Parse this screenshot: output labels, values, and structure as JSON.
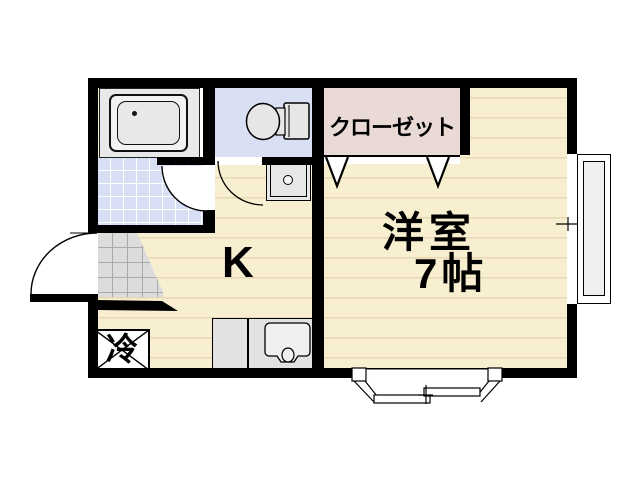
{
  "plan": {
    "rooms": {
      "closet_label": "クローゼット",
      "western_room_label": "洋室",
      "western_room_size": "7帖",
      "kitchen_label": "K",
      "refrigerator_label": "冷"
    },
    "colors": {
      "wall": "#000000",
      "flooring": "#F8EFD0",
      "flooring_line": "#E6D9B4",
      "wet_area_blue": "#D8DEF3",
      "closet_pink": "#E9DAD5",
      "genkan_tile_gray": "#DCDCDC",
      "fixture_gray": "#E7E7E7"
    },
    "fixtures": [
      "bathtub",
      "toilet",
      "washing-machine-pan",
      "kitchen-sink",
      "refrigerator-space",
      "closet-folding-doors",
      "entrance-door",
      "washroom-door",
      "toilet-door",
      "bay-window",
      "side-window"
    ]
  }
}
